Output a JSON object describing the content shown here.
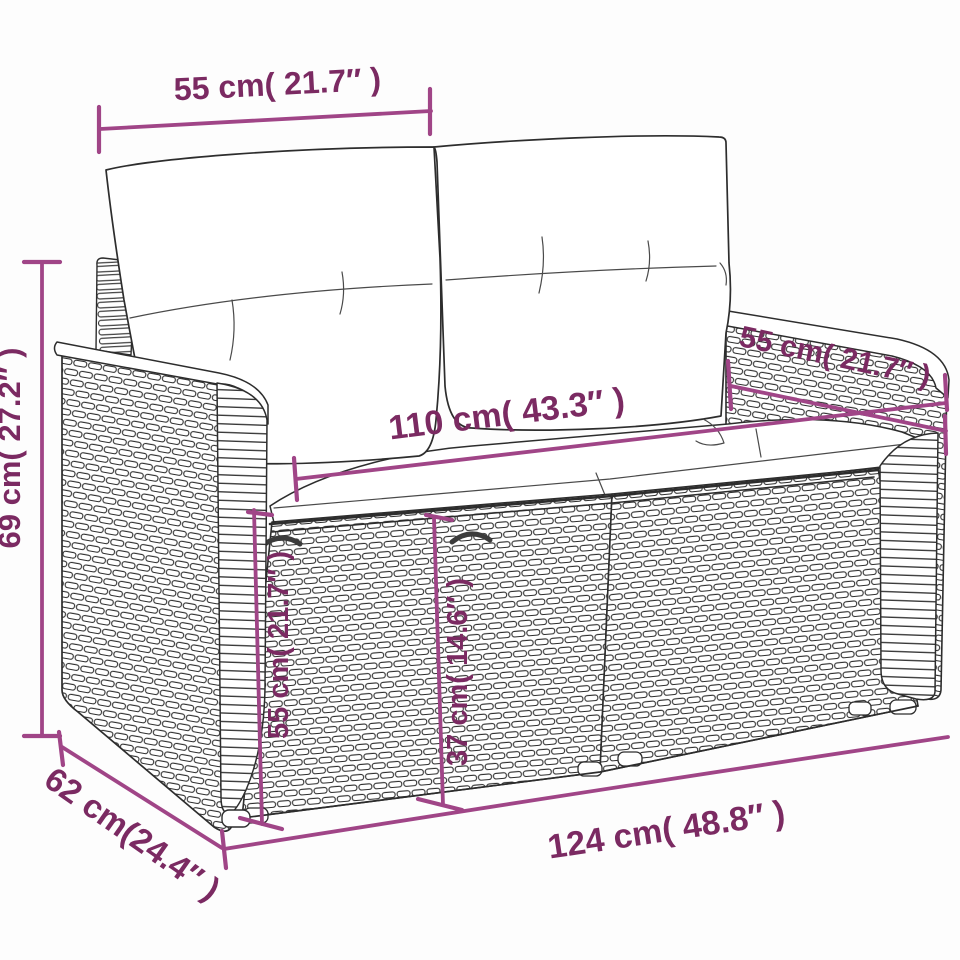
{
  "title": "Rattan 2-seater garden sofa dimension diagram",
  "colors": {
    "dimension_line": "#a04587",
    "dimension_text": "#7b2a62",
    "sketch_line": "#2d2d2d",
    "background": "#fdfdfd"
  },
  "dimensions": {
    "top_width": {
      "label": "55 cm( 21.7″ )",
      "cm": 55,
      "inch": 21.7
    },
    "back_height": {
      "label": "69 cm( 27.2″ )",
      "cm": 69,
      "inch": 27.2
    },
    "right_back_width": {
      "label": "55 cm( 21.7″ )",
      "cm": 55,
      "inch": 21.7
    },
    "seat_width": {
      "label": "110 cm( 43.3″ )",
      "cm": 110,
      "inch": 43.3
    },
    "front_height": {
      "label": "55 cm( 21.7″ )",
      "cm": 55,
      "inch": 21.7
    },
    "seat_height": {
      "label": "37 cm( 14.6″ )",
      "cm": 37,
      "inch": 14.6
    },
    "depth": {
      "label": "62 cm(24.4″ )",
      "cm": 62,
      "inch": 24.4
    },
    "total_width": {
      "label": "124 cm( 48.8″ )",
      "cm": 124,
      "inch": 48.8
    }
  }
}
